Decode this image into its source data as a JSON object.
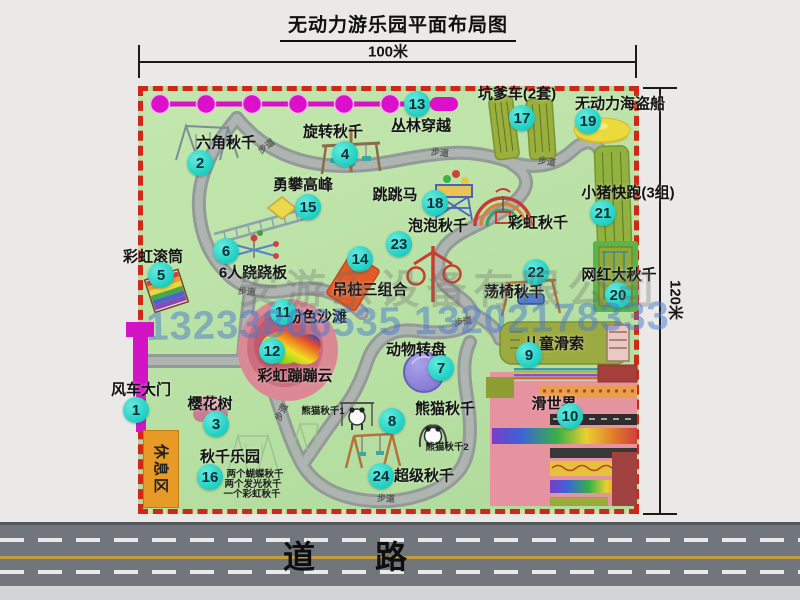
{
  "title": "无动力游乐园平面布局图",
  "dims": {
    "top": "100米",
    "right": "120米"
  },
  "road_label": "道　路",
  "walkway_label": "步道",
  "rest_area_label": "休息区",
  "watermark": {
    "company": "安游乐设备有限公司",
    "phone": "13233806535 13202178333"
  },
  "colors": {
    "park_green": "#b9e2a6",
    "border_red": "#cf2818",
    "badge_cyan": "#26d3c6",
    "zipline_magenta": "#dc10ca",
    "path_gray": "#939a98",
    "rest_orange": "#e89a26"
  },
  "attractions": [
    {
      "id": "windmill-gate",
      "num": "1",
      "label": "风车大门",
      "badge": [
        136,
        410
      ],
      "label_pos": [
        141,
        389
      ]
    },
    {
      "id": "hexagon-swing",
      "num": "2",
      "label": "六角秋千",
      "badge": [
        200,
        163
      ],
      "label_pos": [
        226,
        142
      ]
    },
    {
      "id": "cherry-tree",
      "num": "3",
      "label": "樱花树",
      "badge": [
        216,
        424
      ],
      "label_pos": [
        210,
        403
      ]
    },
    {
      "id": "rotating-swing",
      "num": "4",
      "label": "旋转秋千",
      "badge": [
        345,
        154
      ],
      "label_pos": [
        333,
        131
      ]
    },
    {
      "id": "rainbow-roller",
      "num": "5",
      "label": "彩虹滚筒",
      "badge": [
        161,
        275
      ],
      "label_pos": [
        153,
        256
      ]
    },
    {
      "id": "six-seesaw",
      "num": "6",
      "label": "6人跷跷板",
      "badge": [
        226,
        251
      ],
      "label_pos": [
        253,
        272
      ]
    },
    {
      "id": "animal-turntable",
      "num": "7",
      "label": "动物转盘",
      "badge": [
        441,
        368
      ],
      "label_pos": [
        416,
        349
      ]
    },
    {
      "id": "panda-swing",
      "num": "8",
      "label": "熊猫秋千",
      "badge": [
        392,
        421
      ],
      "label_pos": [
        445,
        408
      ],
      "subs": [
        {
          "text": "熊猫秋千1",
          "pos": [
            323,
            410
          ]
        },
        {
          "text": "熊猫秋千2",
          "pos": [
            447,
            446
          ]
        }
      ]
    },
    {
      "id": "kids-zipline",
      "num": "9",
      "label": "儿童滑索",
      "badge": [
        529,
        355
      ],
      "label_pos": [
        554,
        343
      ]
    },
    {
      "id": "slide-world",
      "num": "10",
      "label": "滑世界",
      "badge": [
        570,
        416
      ],
      "label_pos": [
        554,
        403
      ]
    },
    {
      "id": "pink-beach",
      "num": "11",
      "label": "粉色沙滩",
      "badge": [
        283,
        312
      ],
      "label_pos": [
        317,
        316
      ]
    },
    {
      "id": "rainbow-cloud",
      "num": "12",
      "label": "彩虹蹦蹦云",
      "badge": [
        272,
        351
      ],
      "label_pos": [
        295,
        375
      ]
    },
    {
      "id": "jungle-crossing",
      "num": "13",
      "label": "丛林穿越",
      "badge": [
        417,
        104
      ],
      "label_pos": [
        421,
        125
      ]
    },
    {
      "id": "hanging-piles",
      "num": "14",
      "label": "吊桩三组合",
      "badge": [
        360,
        259
      ],
      "label_pos": [
        370,
        289
      ]
    },
    {
      "id": "climbing-peak",
      "num": "15",
      "label": "勇攀高峰",
      "badge": [
        308,
        207
      ],
      "label_pos": [
        303,
        184
      ]
    },
    {
      "id": "swing-park",
      "num": "16",
      "label": "秋千乐园",
      "badge": [
        210,
        477
      ],
      "label_pos": [
        230,
        456
      ],
      "subs": [
        {
          "text": "两个蝴蝶秋千",
          "pos": [
            255,
            473
          ]
        },
        {
          "text": "两个发光秋千",
          "pos": [
            253,
            483
          ]
        },
        {
          "text": "一个彩虹秋千",
          "pos": [
            252,
            493
          ]
        }
      ]
    },
    {
      "id": "pit-car",
      "num": "17",
      "label": "坑爹车(2套)",
      "badge": [
        522,
        118
      ],
      "label_pos": [
        517,
        93
      ]
    },
    {
      "id": "jumping-horse",
      "num": "18",
      "label": "跳跳马",
      "badge": [
        435,
        203
      ],
      "label_pos": [
        395,
        194
      ]
    },
    {
      "id": "pirate-ship",
      "num": "19",
      "label": "无动力海盗船",
      "badge": [
        588,
        121
      ],
      "label_pos": [
        620,
        103
      ]
    },
    {
      "id": "big-swing",
      "num": "20",
      "label": "网红大秋千",
      "badge": [
        618,
        295
      ],
      "label_pos": [
        619,
        274
      ]
    },
    {
      "id": "piggy-run",
      "num": "21",
      "label": "小猪快跑(3组)",
      "badge": [
        603,
        213
      ],
      "label_pos": [
        628,
        192
      ]
    },
    {
      "id": "chair-swing",
      "num": "22",
      "label": "荡椅秋千",
      "badge": [
        536,
        272
      ],
      "label_pos": [
        514,
        291
      ]
    },
    {
      "id": "bubble-swing",
      "num": "23",
      "label": "泡泡秋千",
      "badge": [
        399,
        244
      ],
      "label_pos": [
        438,
        225
      ]
    },
    {
      "id": "super-swing",
      "num": "24",
      "label": "超级秋千",
      "badge": [
        381,
        476
      ],
      "label_pos": [
        424,
        475
      ]
    },
    {
      "id": "rainbow-swing",
      "num": null,
      "label": "彩虹秋千",
      "badge": null,
      "label_pos": [
        538,
        222
      ]
    }
  ],
  "walkway_tags": [
    {
      "x": 266,
      "y": 146,
      "r": -38
    },
    {
      "x": 440,
      "y": 152,
      "r": 6
    },
    {
      "x": 547,
      "y": 161,
      "r": 8
    },
    {
      "x": 247,
      "y": 291,
      "r": 5
    },
    {
      "x": 463,
      "y": 321,
      "r": -10
    },
    {
      "x": 281,
      "y": 412,
      "r": -64
    },
    {
      "x": 386,
      "y": 498,
      "r": 3
    }
  ]
}
